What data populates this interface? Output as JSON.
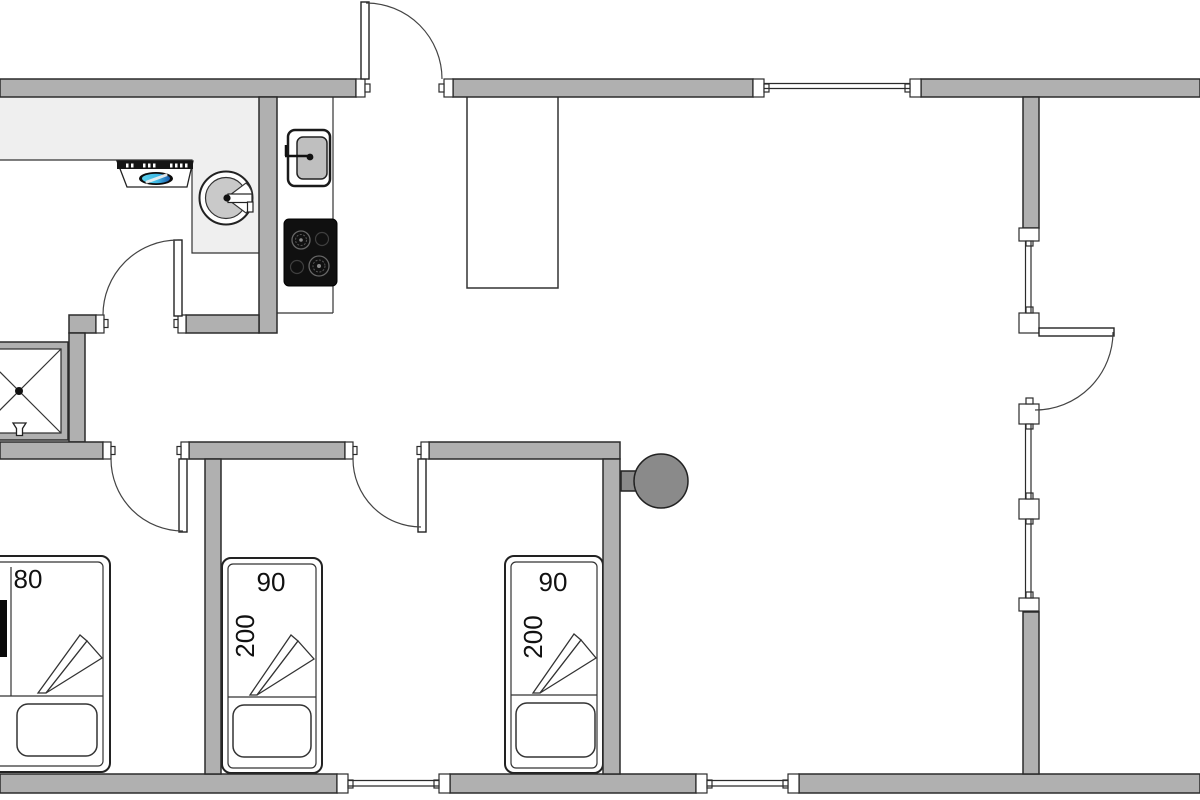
{
  "floorplan": {
    "beds": [
      {
        "name": "double-bed",
        "width_label": "80"
      },
      {
        "name": "single-bed-left",
        "width_label": "90",
        "length_label": "200"
      },
      {
        "name": "single-bed-right",
        "width_label": "90",
        "length_label": "200"
      }
    ],
    "colors": {
      "wall": "#b0b0b0",
      "outline": "#2b2b2b",
      "kitchen_counter": "#efefef",
      "wood_stove": "#8a8a8a",
      "hob": "#101010",
      "sink_basin": "#c9c9c9",
      "hood_light_cyan": "#5cd2ee",
      "hood_light_blue": "#1b5cb0"
    }
  }
}
